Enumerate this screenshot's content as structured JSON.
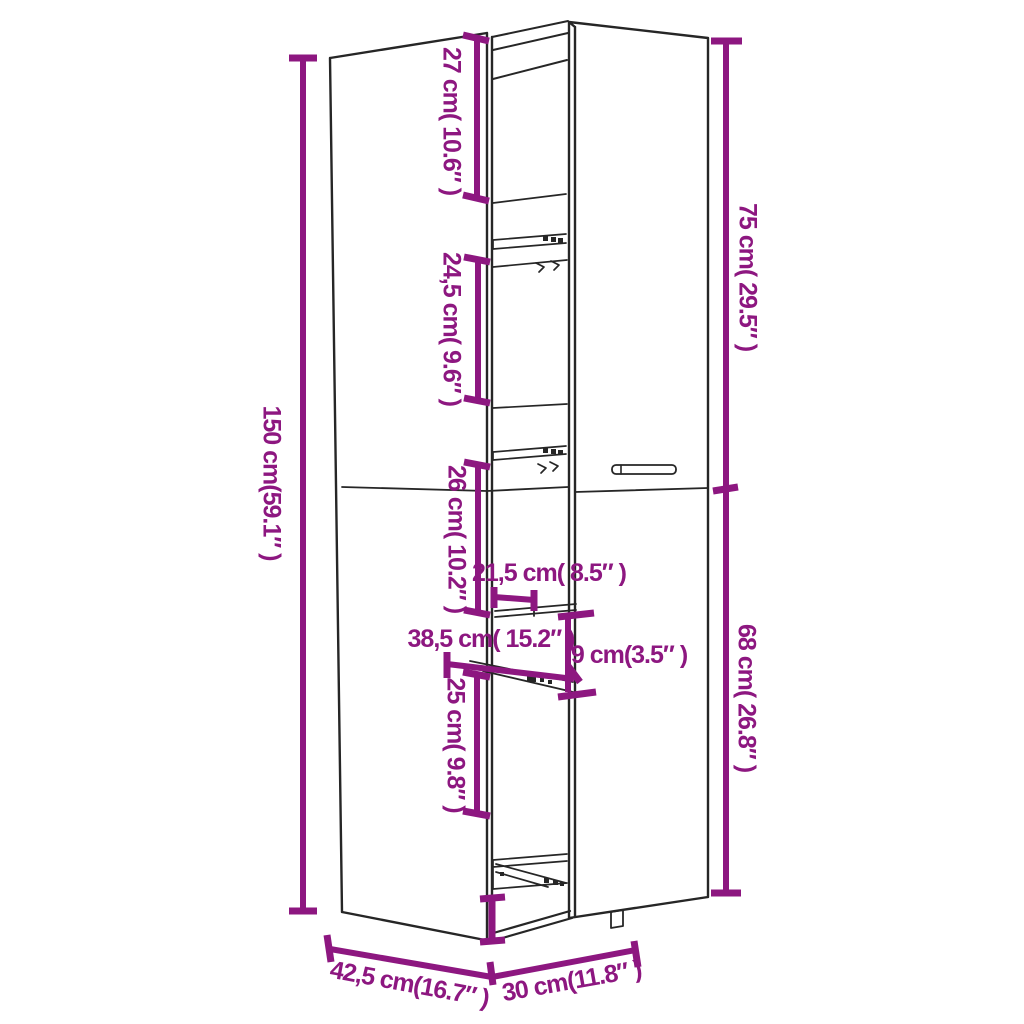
{
  "diagram": {
    "kind": "product-dimension-diagram",
    "subject": "tall pull-out storage cabinet line drawing",
    "colors": {
      "dimension": "#8D1780",
      "outline": "#262626",
      "background": "#ffffff"
    },
    "labels": {
      "total_height": "150 cm(59.1″ )",
      "top_compartment_height": "27 cm( 10.6″ )",
      "upper_compartment_height": "24,5 cm( 9.6″ )",
      "middle_compartment_height": "26 cm( 10.2″ )",
      "internal_width": "21,5 cm( 8.5″ )",
      "pullout_depth": "38,5 cm( 15.2″ )",
      "basket_height": "9 cm(3.5″ )",
      "lower_compartment_height": "25 cm( 9.8″ )",
      "upper_door_height": "75 cm( 29.5″ )",
      "lower_door_height": "68 cm( 26.8″ )",
      "cabinet_depth": "42,5 cm(16.7″ )",
      "cabinet_width": "30 cm(11.8″ )"
    }
  }
}
